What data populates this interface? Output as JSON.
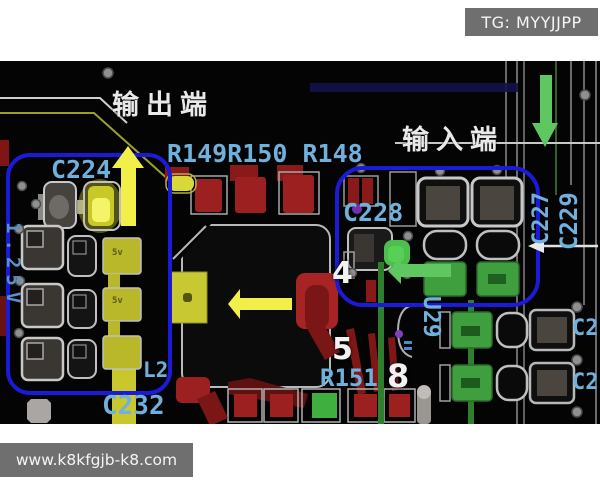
{
  "watermarks": {
    "telegram": "TG: MYYJJPP",
    "website": "www.k8kfgjb-k8.com"
  },
  "annotations": {
    "output_label": "输出端",
    "input_label": "输入端"
  },
  "silkscreen": {
    "c224": "C224",
    "r_row": "R149R150 R148",
    "c228": "C228",
    "c227": "C227",
    "c229": "C229",
    "u29": "U29",
    "r151": "R151",
    "c232": "C232",
    "l2": "L2",
    "left_rail": "1.25V",
    "pin4": "4",
    "pin5": "5",
    "pin8": "8",
    "c2_partial_top": "C2",
    "c2_partial_bottom": "C2",
    "pad_5v_a": "5v",
    "pad_5v_b": "5v"
  },
  "colors": {
    "annotation_blue": "#1a1ad8",
    "arrow_yellow": "#f2ee4a",
    "arrow_green": "#5fc75f",
    "arrow_white": "#e8e8e8",
    "silkscreen_blue": "#6fb0dc",
    "copper_red": "#9c2020",
    "pad_green": "#3f9f3f",
    "pad_yellow": "#c8c832",
    "watermark_bg": "#6f6f6f",
    "board_bg": "#040404"
  }
}
